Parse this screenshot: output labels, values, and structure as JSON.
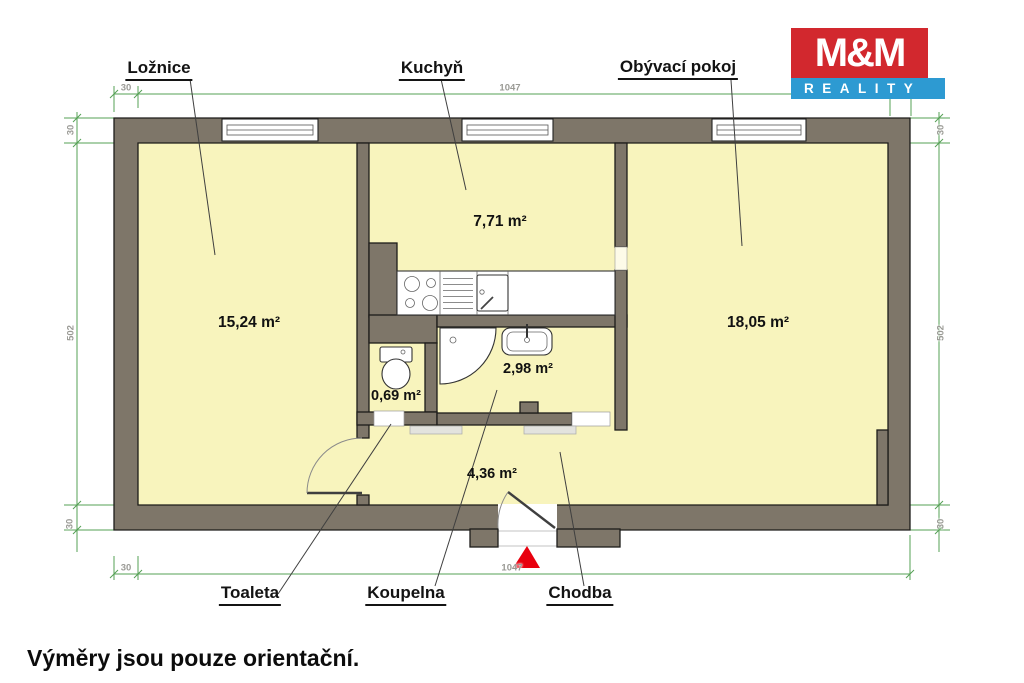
{
  "logo": {
    "top": "M&M",
    "bottom": "REALITY"
  },
  "rooms": {
    "loznice": {
      "name": "Ložnice",
      "area": "15,24 m²"
    },
    "kuchyn": {
      "name": "Kuchyň",
      "area": "7,71 m²"
    },
    "obyvaci_pokoj": {
      "name": "Obývací pokoj",
      "area": "18,05 m²"
    },
    "toaleta": {
      "name": "Toaleta",
      "area": "0,69 m²"
    },
    "koupelna": {
      "name": "Koupelna",
      "area": "2,98 m²"
    },
    "chodba": {
      "name": "Chodba",
      "area": "4,36 m²"
    }
  },
  "dimensions": {
    "top_total": "1047",
    "top_wall": "30",
    "bottom_total": "1047",
    "bottom_wall": "30",
    "left_wall": "30",
    "left_total": "502",
    "left_bottom_wall": "30",
    "right_wall": "30",
    "right_total": "502",
    "right_bottom_wall": "30"
  },
  "footer": {
    "disclaimer": "Výměry jsou pouze orientační."
  },
  "colors": {
    "floor": "#f8f4bd",
    "wall": "#7e7669",
    "wall_outline": "#1d1c1a",
    "dim_line": "#54a054",
    "dim_text": "#9a9a95",
    "leader": "#3f3f3f",
    "logo_red": "#d2282e",
    "logo_blue": "#2d9ad2",
    "marker_red": "#e8000e",
    "mat": "#e3e3de"
  }
}
